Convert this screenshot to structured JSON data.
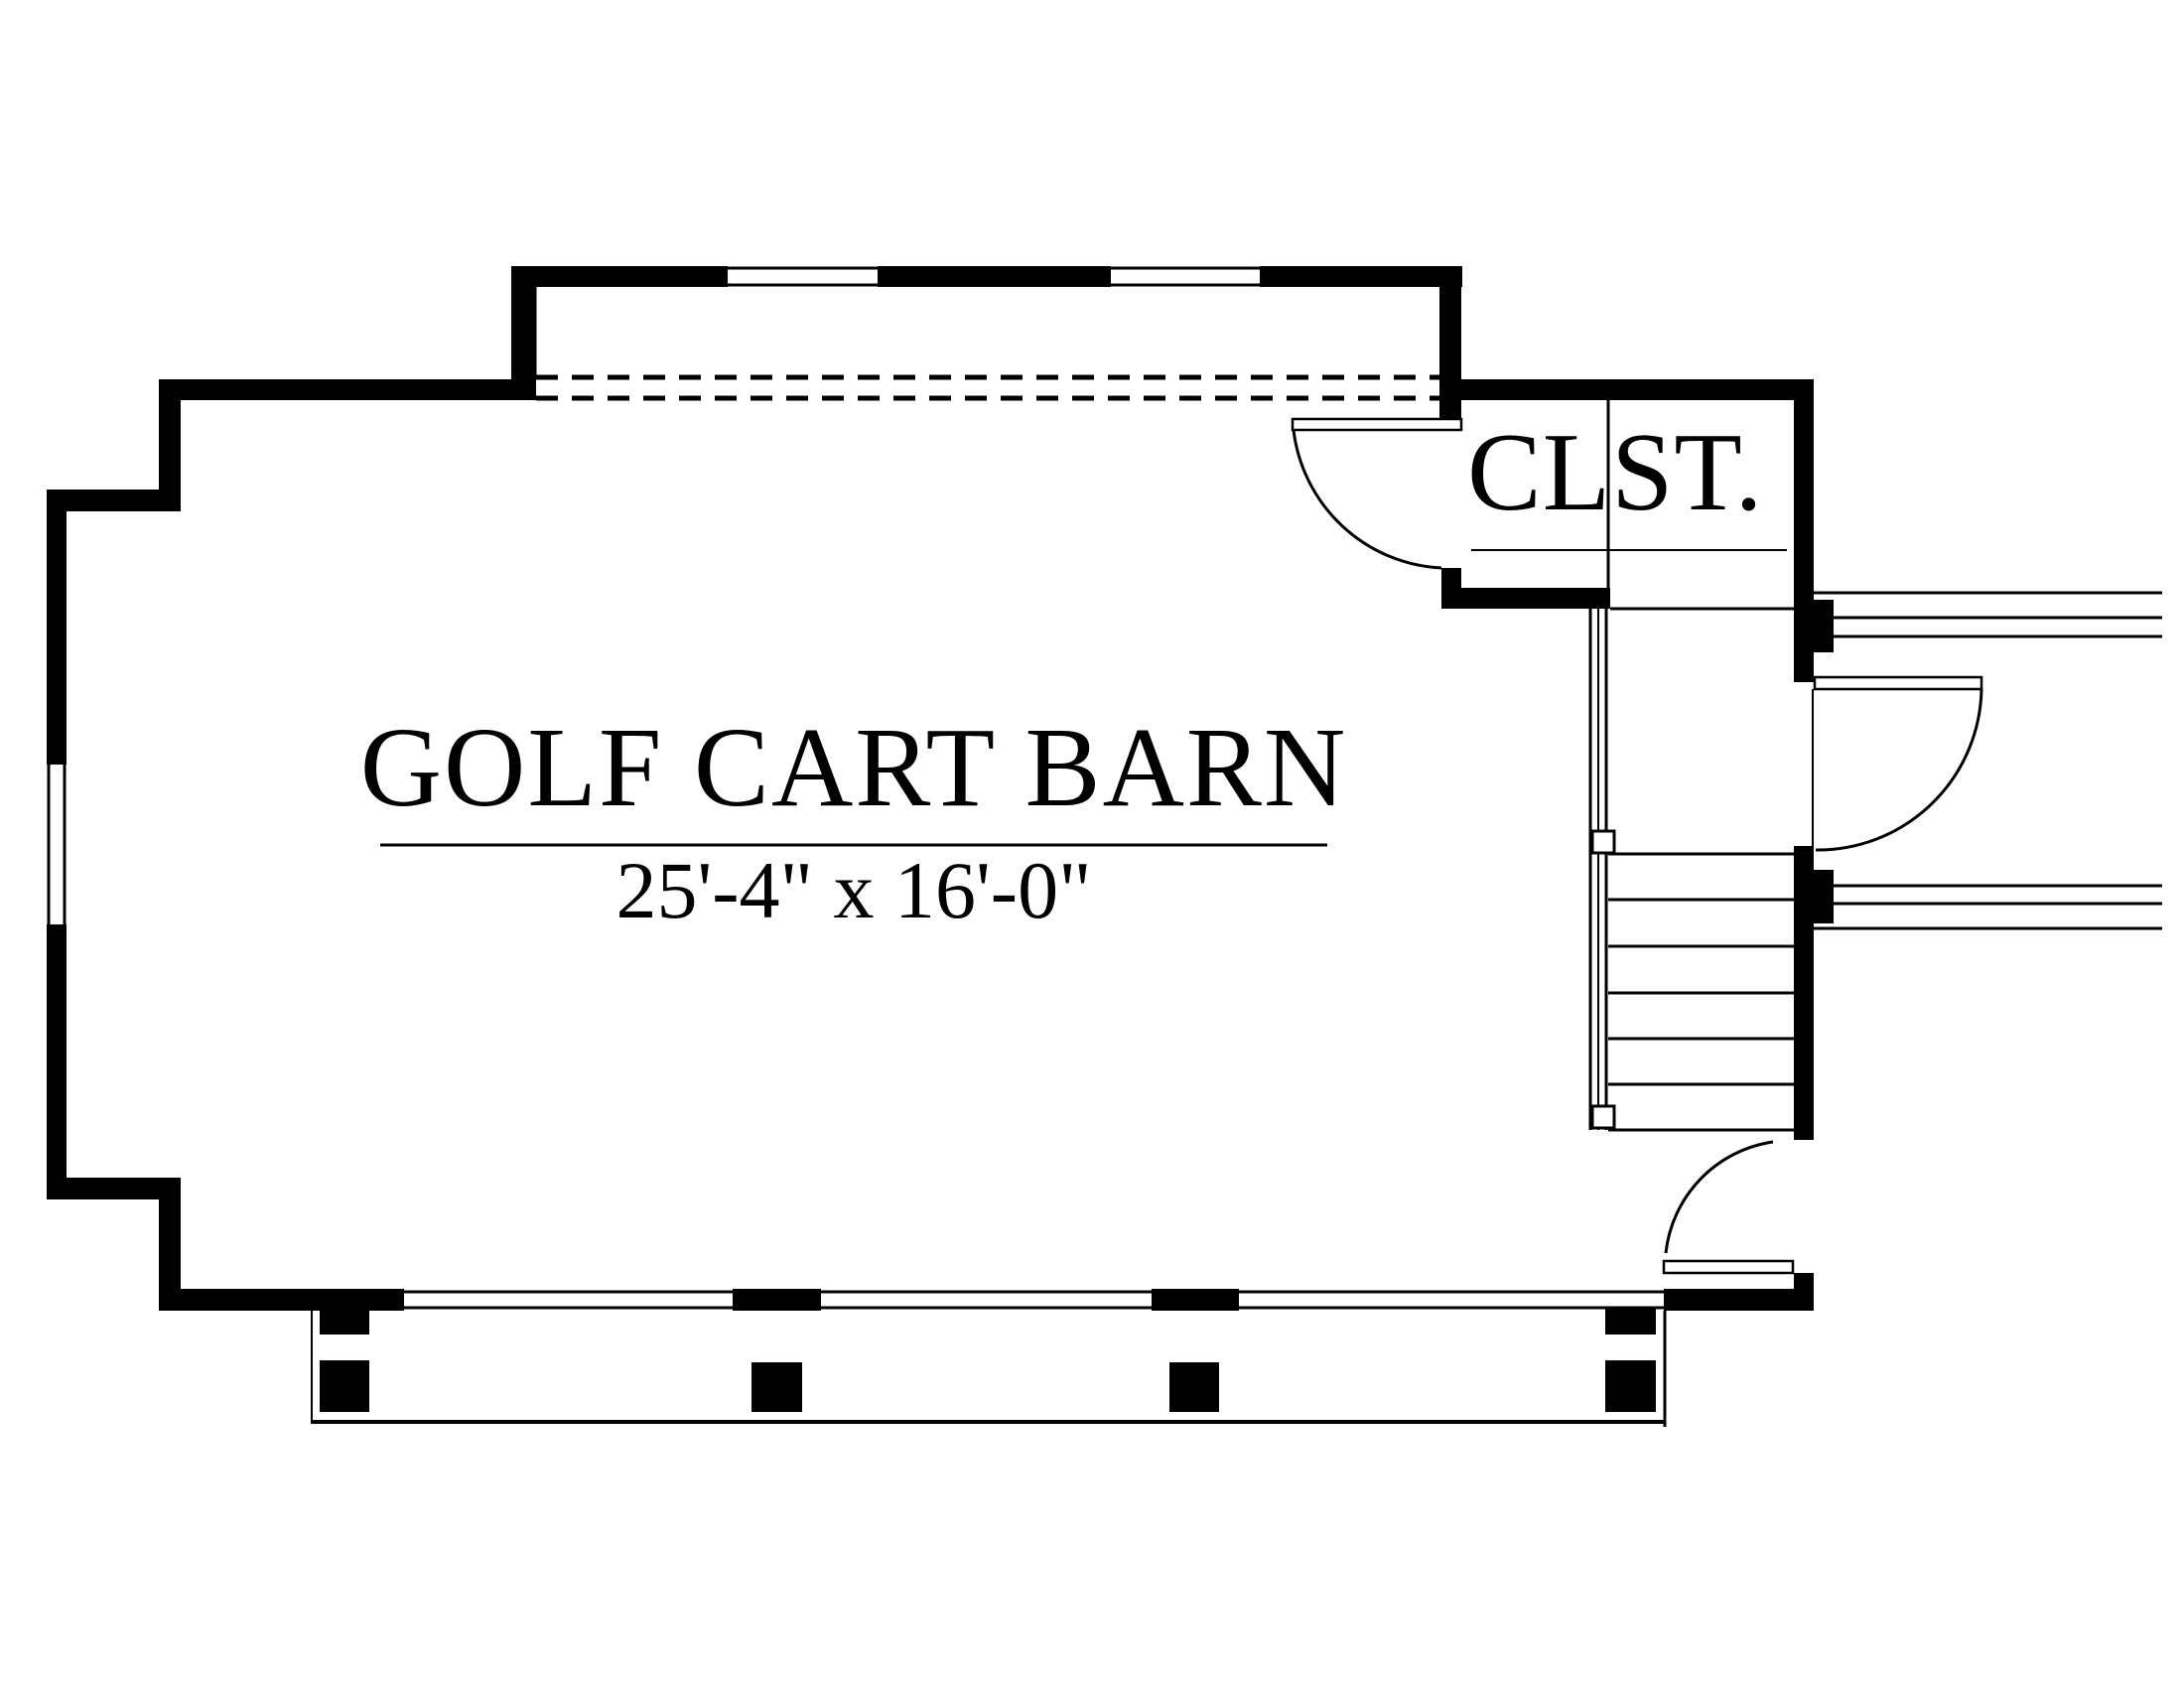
{
  "page": {
    "background": "#ffffff",
    "line_color": "#000000"
  },
  "rooms": {
    "golf_cart_barn": {
      "name": "GOLF CART BARN",
      "dimensions": "25'-4\" x 16'-0\""
    },
    "closet": {
      "name": "CLST."
    }
  }
}
